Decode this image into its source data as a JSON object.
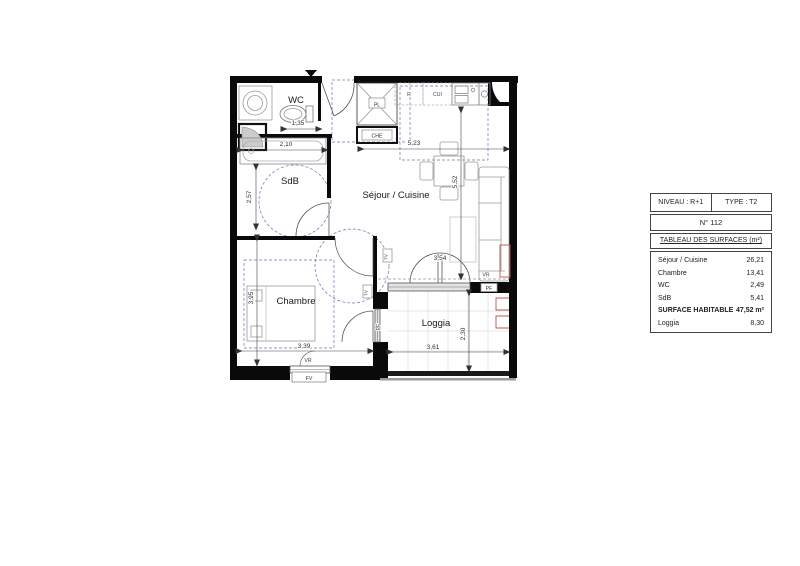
{
  "plan": {
    "rooms": {
      "wc": "WC",
      "sdb": "SdB",
      "sejour": "Séjour / Cuisine",
      "chambre": "Chambre",
      "loggia": "Loggia"
    },
    "dims": {
      "wc_width": "1,35",
      "bath_length": "2,10",
      "sdb_depth": "2,57",
      "sejour_width": "5,23",
      "sejour_depth": "5,52",
      "chambre_depth": "3,95",
      "chambre_width": "3,39",
      "bay_width": "3,54",
      "loggia_width": "3,61",
      "loggia_depth": "2,30"
    },
    "tags": {
      "closet": "PL",
      "water_heater": "CHE",
      "fridge": "R",
      "cooker": "CUI",
      "roller_shutter": "VR",
      "french_window": "PF",
      "window": "FV",
      "tv_outlet": "TV"
    }
  },
  "panel": {
    "level": "NIVEAU : R+1",
    "type": "TYPE : T2",
    "unit": "N° 112",
    "title": "TABLEAU DES SURFACES (m²)",
    "rows": [
      {
        "label": "Séjour / Cuisine",
        "value": "26,21"
      },
      {
        "label": "Chambre",
        "value": "13,41"
      },
      {
        "label": "WC",
        "value": "2,49"
      },
      {
        "label": "SdB",
        "value": "5,41"
      }
    ],
    "total": {
      "label": "SURFACE HABITABLE",
      "value": "47,52 m²"
    },
    "annex": {
      "label": "Loggia",
      "value": "8,30"
    }
  },
  "colors": {
    "wall": "#0a0a0a",
    "guide_dashed": "#7070b8",
    "heater_red": "#c0504d"
  }
}
